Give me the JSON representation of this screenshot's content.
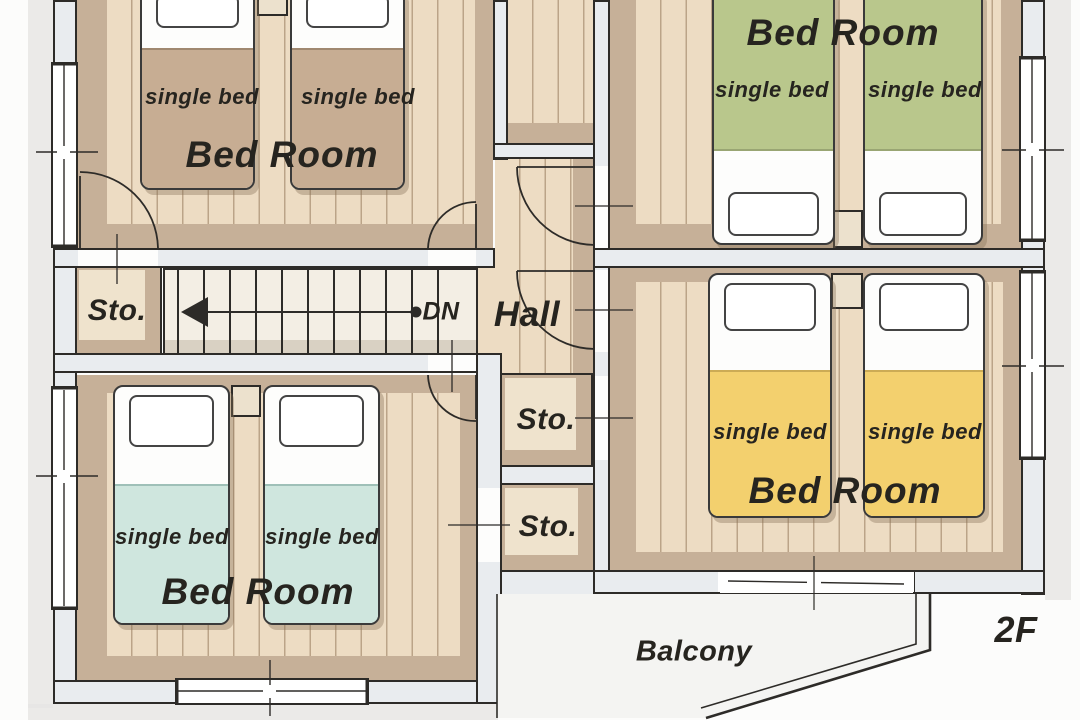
{
  "floor_badge": "2F",
  "rooms": {
    "bedroom_top_left": {
      "name": "Bed Room",
      "bed1": "single bed",
      "bed2": "single bed"
    },
    "bedroom_top_right": {
      "name": "Bed Room",
      "bed1": "single bed",
      "bed2": "single bed"
    },
    "bedroom_bottom_left": {
      "name": "Bed Room",
      "bed1": "single bed",
      "bed2": "single bed"
    },
    "bedroom_right": {
      "name": "Bed Room",
      "bed1": "single bed",
      "bed2": "single bed"
    }
  },
  "storage": {
    "left": "Sto.",
    "mid_upper": "Sto.",
    "mid_lower": "Sto."
  },
  "hall": {
    "name": "Hall"
  },
  "stairs": {
    "down_label": "DN"
  },
  "balcony": {
    "name": "Balcony"
  },
  "colors": {
    "canvas": "#fcfcfb",
    "line": "#2d2b28",
    "wall_fill": "#e9ecef",
    "floor_light": "#eddcc3",
    "floor_band": "#c6b098",
    "sto_floor": "#efe3cd",
    "stairs_fill": "#f3eee4",
    "stairs_shadow": "#d9d1c3",
    "balcony_fill": "#f4f4f2",
    "outside_wash": "#e6e5e3",
    "bed_tan": "#c7ad93",
    "bed_green": "#b9c78c",
    "bed_teal": "#cfe6de",
    "bed_yellow": "#f3d06e",
    "stand": "#ece1cd",
    "pillow": "#ffffff",
    "text": "#26241f"
  }
}
